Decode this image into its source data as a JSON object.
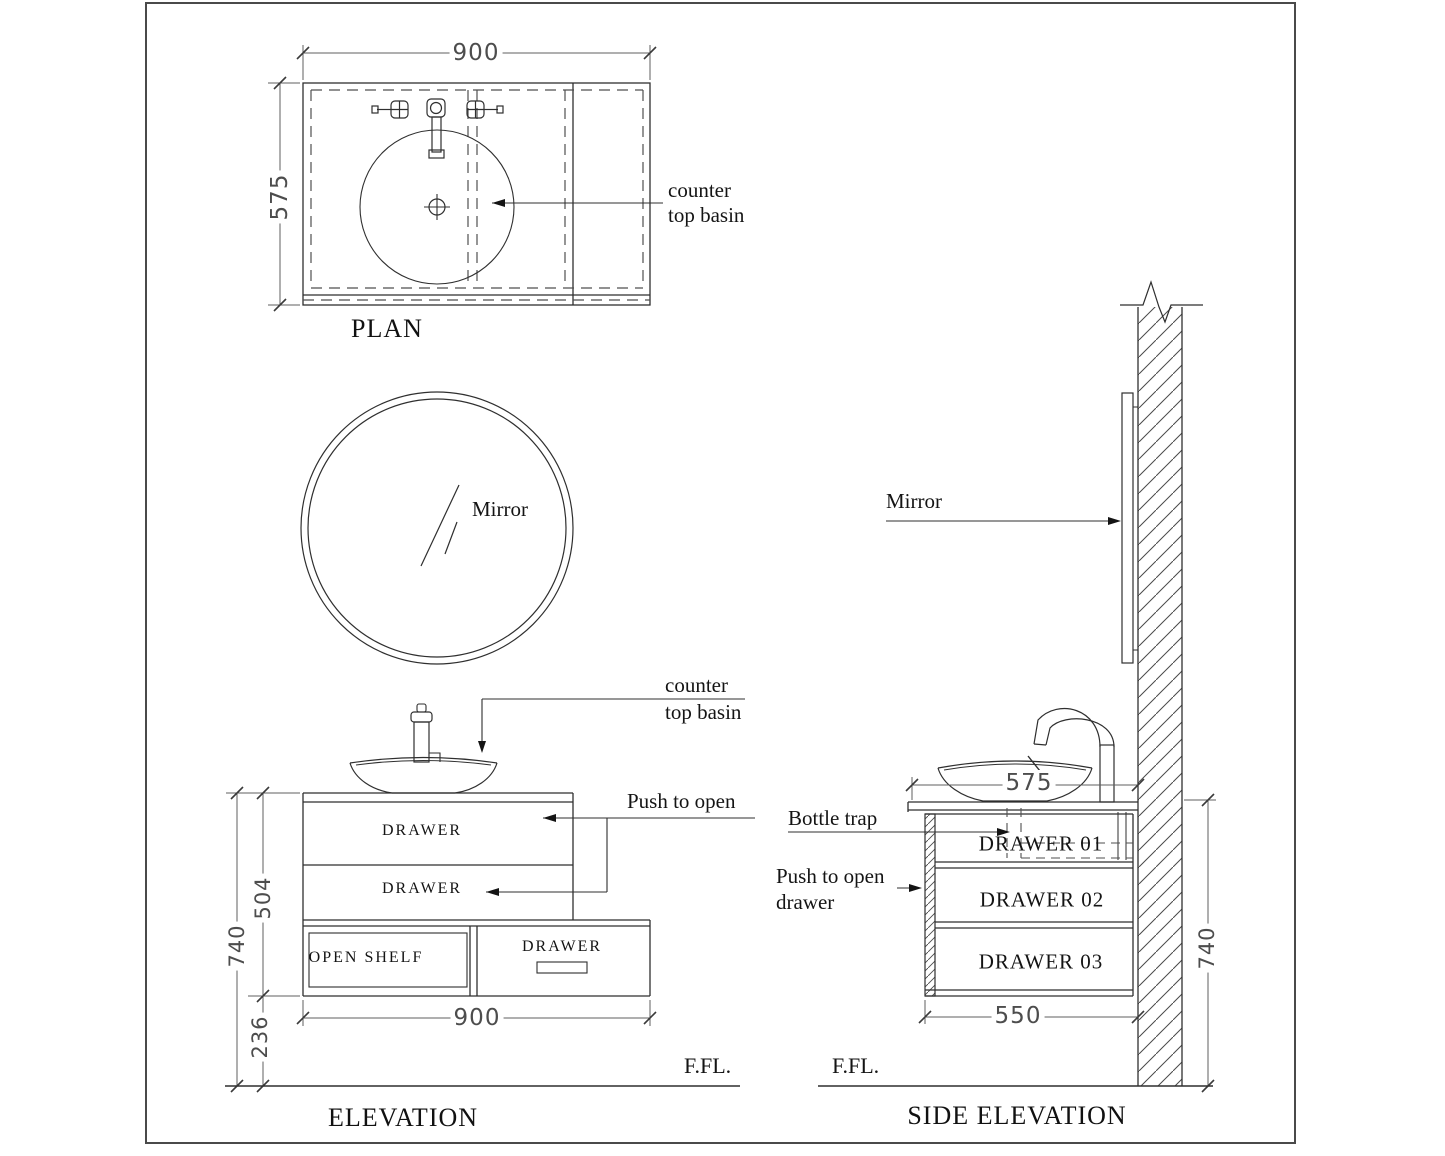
{
  "drawing": {
    "plan": {
      "title": "PLAN",
      "dim_width": "900",
      "dim_depth": "575",
      "basin_label_1": "counter",
      "basin_label_2": "top basin"
    },
    "mirror": {
      "label": "Mirror"
    },
    "elevation": {
      "title": "ELEVATION",
      "basin_label_1": "counter",
      "basin_label_2": "top basin",
      "push_label": "Push to open",
      "drawer_top": "DRAWER",
      "drawer_middle": "DRAWER",
      "open_shelf": "OPEN SHELF",
      "drawer_bottom": "DRAWER",
      "dim_height_total": "740",
      "dim_height_cabinet": "504",
      "dim_height_clearance": "236",
      "dim_width": "900",
      "floor_label": "F.FL."
    },
    "side_elevation": {
      "title": "SIDE ELEVATION",
      "mirror_label": "Mirror",
      "bottle_trap_label": "Bottle trap",
      "push_label_1": "Push to open",
      "push_label_2": "drawer",
      "drawer_01": "DRAWER 01",
      "drawer_02": "DRAWER 02",
      "drawer_03": "DRAWER 03",
      "dim_counter_depth": "575",
      "dim_cabinet_depth": "550",
      "dim_height_total": "740",
      "floor_label": "F.FL."
    },
    "colors": {
      "line": "#2f2f2f",
      "dim_line": "#5f5f5f",
      "text": "#141414",
      "background": "#ffffff",
      "frame": "#4a4a4a"
    }
  }
}
